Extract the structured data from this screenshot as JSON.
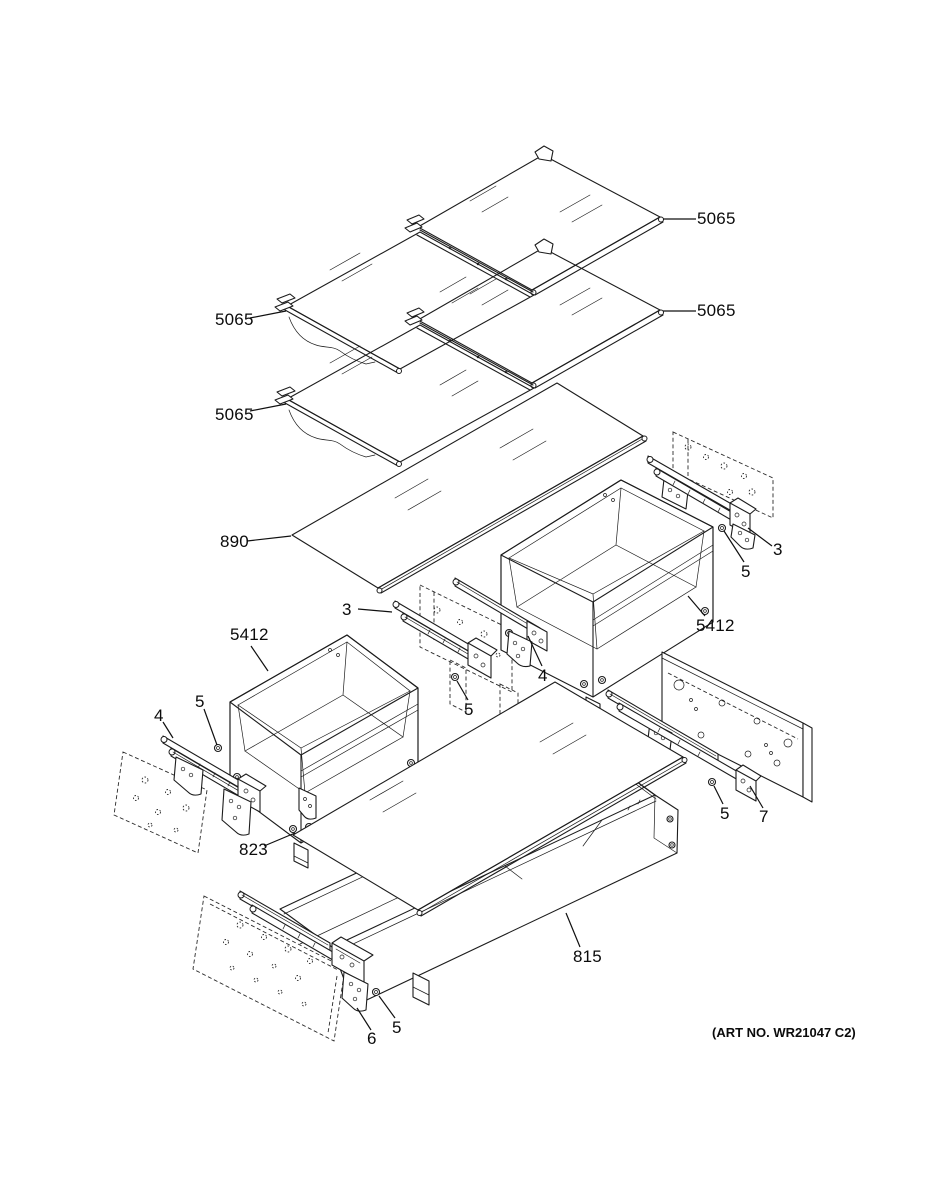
{
  "figure": {
    "kind": "exploded parts diagram",
    "subject": "refrigerator shelf and drawer assembly",
    "art_no": "(ART NO. WR21047 C2)"
  },
  "callouts": [
    {
      "id": "shelf-glass-top-right",
      "text": "5065"
    },
    {
      "id": "shelf-glass-mid-right",
      "text": "5065"
    },
    {
      "id": "shelf-glass-upper-left",
      "text": "5065"
    },
    {
      "id": "shelf-glass-lower-left",
      "text": "5065"
    },
    {
      "id": "glass-cover-890",
      "text": "890"
    },
    {
      "id": "slide-rail-right",
      "text": "3"
    },
    {
      "id": "screw-right",
      "text": "5"
    },
    {
      "id": "drawer-right",
      "text": "5412"
    },
    {
      "id": "slide-rail-middle",
      "text": "3"
    },
    {
      "id": "bracket-middle",
      "text": "4"
    },
    {
      "id": "screw-middle",
      "text": "5"
    },
    {
      "id": "drawer-left",
      "text": "5412"
    },
    {
      "id": "screw-left",
      "text": "5"
    },
    {
      "id": "bracket-left",
      "text": "4"
    },
    {
      "id": "glass-cover-823",
      "text": "823"
    },
    {
      "id": "slide-rail-lower-right",
      "text": "7"
    },
    {
      "id": "screw-lower-right",
      "text": "5"
    },
    {
      "id": "drawer-bottom",
      "text": "815"
    },
    {
      "id": "bracket-bottom",
      "text": "6"
    },
    {
      "id": "screw-bottom",
      "text": "5"
    }
  ]
}
